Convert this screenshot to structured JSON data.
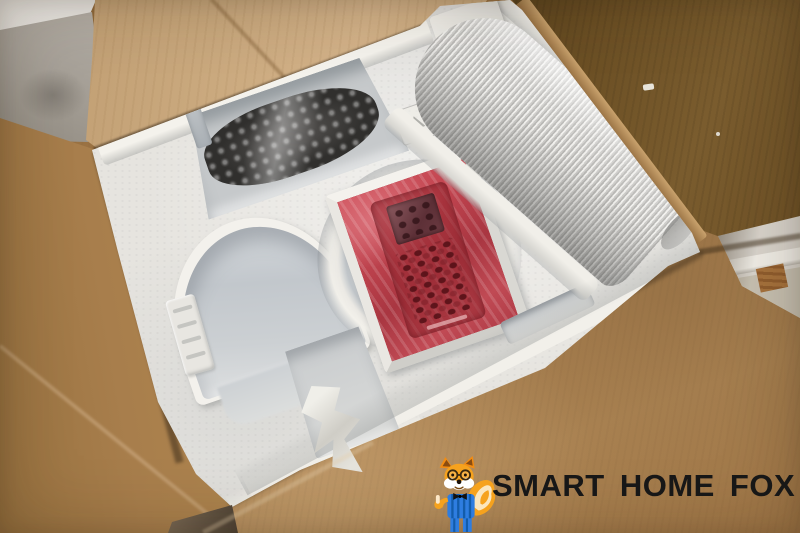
{
  "meta": {
    "type": "photograph",
    "subject": "Opened cardboard shipping box with a white styrofoam insert holding portable air-conditioner accessories",
    "width_px": 800,
    "height_px": 533
  },
  "logo": {
    "text": "SMART HOME FOX",
    "mascot": "cartoon fox with glasses, bow tie, blue striped suit, thumbs up",
    "text_color": "#171717"
  },
  "scene": {
    "background_elements": [
      "white wall corner",
      "grey sofa fabric",
      "white wall with baseboard and wood floor seen through flap gap"
    ],
    "box": {
      "flaps": [
        "light tan top-left flap",
        "dark brown top-right flap",
        "brown left flap",
        "brown bottom flap"
      ],
      "colors": {
        "flap_light": "#c9a87d",
        "flap_dark": "#6b4f24",
        "flap_bottom": "#a87e4e"
      }
    },
    "foam_insert": {
      "color": "#e6e4df",
      "recesses": [
        "trapezoid recess with bubble-wrapped dark power cord",
        "circular well with rectangular recess holding remote control in red film",
        "empty arched recess (left)",
        "diagonal channel with white corrugated exhaust hose",
        "small recess with crumpled clear plastic wrap",
        "embossed strip marking",
        "embossed recycling mark"
      ]
    },
    "items": {
      "remote_wrap_color": "#c24550",
      "hose_color": "#d7d6d3",
      "cable_color": "#302f2d",
      "fox_orange": "#f6a21d",
      "fox_blue": "#2e7de0"
    }
  }
}
